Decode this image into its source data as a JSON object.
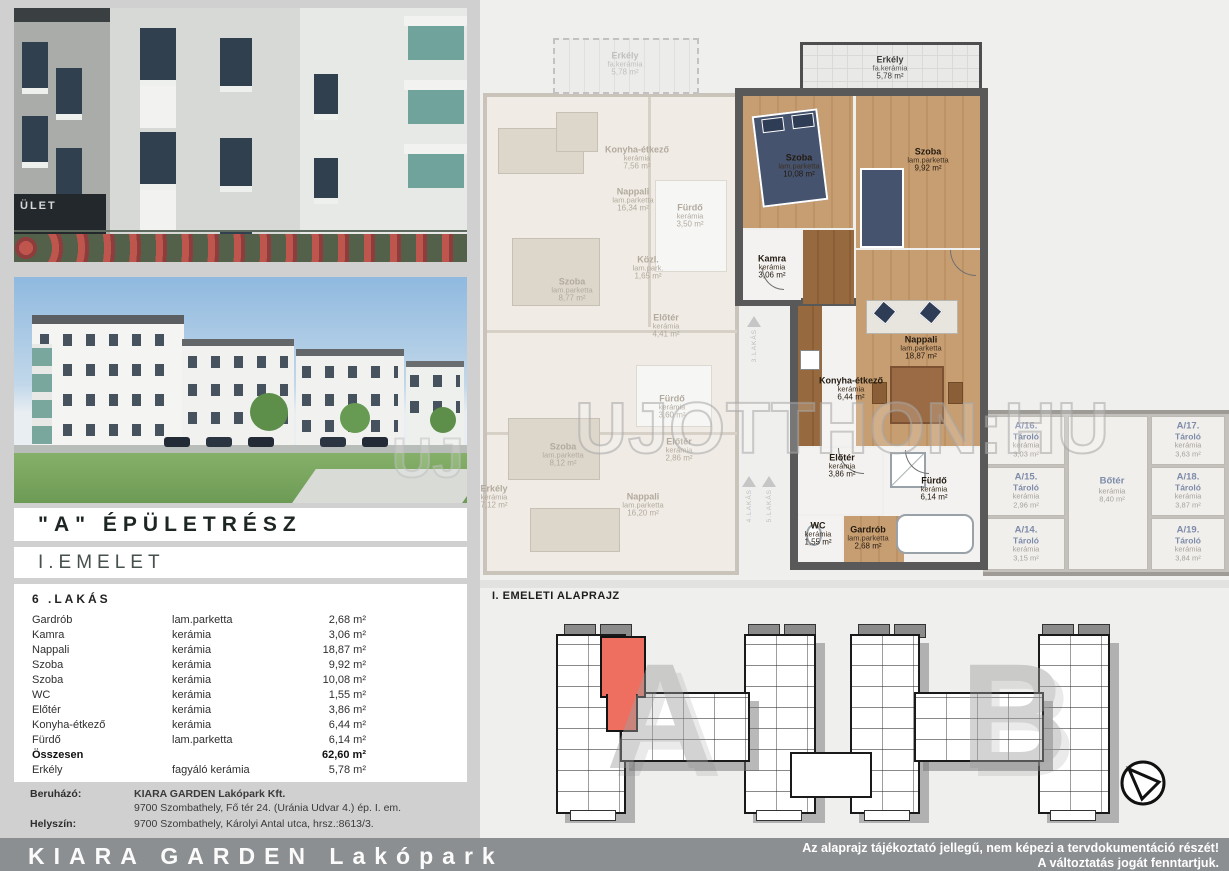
{
  "left": {
    "photo1": {
      "sign": "ÜLET"
    },
    "photo2": {
      "watermark": "UJ"
    },
    "building_title": "\"A\" ÉPÜLETRÉSZ",
    "floor_title": "I.EMELET",
    "table": {
      "title": "6 .LAKÁS",
      "rows": [
        {
          "name": "Gardrób",
          "material": "lam.parketta",
          "area": "2,68 m²"
        },
        {
          "name": "Kamra",
          "material": "kerámia",
          "area": "3,06 m²"
        },
        {
          "name": "Nappali",
          "material": "kerámia",
          "area": "18,87 m²"
        },
        {
          "name": "Szoba",
          "material": "kerámia",
          "area": "9,92 m²"
        },
        {
          "name": "Szoba",
          "material": "kerámia",
          "area": "10,08 m²"
        },
        {
          "name": "WC",
          "material": "kerámia",
          "area": "1,55 m²"
        },
        {
          "name": "Előtér",
          "material": "kerámia",
          "area": "3,86 m²"
        },
        {
          "name": "Konyha-étkező",
          "material": "kerámia",
          "area": "6,44 m²"
        },
        {
          "name": "Fürdő",
          "material": "lam.parketta",
          "area": "6,14 m²"
        }
      ],
      "total": {
        "name": "Összesen",
        "area": "62,60 m²"
      },
      "balcony": {
        "name": "Erkély",
        "material": "fagyáló kerámia",
        "area": "5,78 m²"
      }
    },
    "info": {
      "developer_label": "Beruházó:",
      "developer_name": "KIARA GARDEN Lakópark Kft.",
      "developer_address": "9700 Szombathely, Fő tér 24. (Uránia Udvar 4.) ép. I. em.",
      "site_label": "Helyszín:",
      "site_address": "9700 Szombathely, Károlyi Antal utca, hrsz.:8613/3."
    }
  },
  "footer": {
    "brand": "KIARA GARDEN Lakópark",
    "disclaimer1": "Az alaprajz tájékoztató jellegű, nem képezi a tervdokumentáció részét!",
    "disclaimer2": "A változtatás jogát fenntartjuk."
  },
  "plan": {
    "watermark": "UJOTTHON:HU",
    "balcony_main": {
      "name": "Erkély",
      "material": "fa.kerámia",
      "area": "5,78 m²"
    },
    "balcony_faded": {
      "name": "Erkély",
      "material": "fa.kerámia",
      "area": "5,78 m²"
    },
    "main_flat": [
      {
        "name": "Szoba",
        "material": "lam.parketta",
        "area": "10,08 m²"
      },
      {
        "name": "Szoba",
        "material": "lam.parketta",
        "area": "9,92 m²"
      },
      {
        "name": "Kamra",
        "material": "kerámia",
        "area": "3,06 m²"
      },
      {
        "name": "Nappali",
        "material": "lam.parketta",
        "area": "18,87 m²"
      },
      {
        "name": "Konyha-étkező",
        "material": "kerámia",
        "area": "6,44 m²"
      },
      {
        "name": "Előtér",
        "material": "kerámia",
        "area": "3,86 m²"
      },
      {
        "name": "Fürdő",
        "material": "kerámia",
        "area": "6,14 m²"
      },
      {
        "name": "WC",
        "material": "kerámia",
        "area": "1,55 m²"
      },
      {
        "name": "Gardrób",
        "material": "lam.parketta",
        "area": "2,68 m²"
      }
    ],
    "faded_flat": [
      {
        "name": "Konyha-étkező",
        "material": "kerámia",
        "area": "7,56 m²"
      },
      {
        "name": "Nappali",
        "material": "lam.parketta",
        "area": "16,34 m²"
      },
      {
        "name": "Fürdő",
        "material": "kerámia",
        "area": "3,50 m²"
      },
      {
        "name": "Közl.",
        "material": "lam.park.",
        "area": "1,65 m²"
      },
      {
        "name": "Szoba",
        "material": "lam.parketta",
        "area": "8,77 m²"
      },
      {
        "name": "Előtér",
        "material": "kerámia",
        "area": "4,41 m²"
      },
      {
        "name": "Szoba",
        "material": "lam.parketta",
        "area": "8,12 m²"
      },
      {
        "name": "Fürdő",
        "material": "kerámia",
        "area": "3,60 m²"
      },
      {
        "name": "Előtér",
        "material": "kerámia",
        "area": "2,86 m²"
      },
      {
        "name": "Nappali",
        "material": "lam.parketta",
        "area": "16,20 m²"
      },
      {
        "name": "Erkély",
        "material": "kerámia",
        "area": "7,12 m²"
      }
    ],
    "storage": [
      {
        "name": "A/16.",
        "type": "Tároló",
        "material": "kerámia",
        "area": "3,03 m²"
      },
      {
        "name": "A/15.",
        "type": "Tároló",
        "material": "kerámia",
        "area": "2,96 m²"
      },
      {
        "name": "A/14.",
        "type": "Tároló",
        "material": "kerámia",
        "area": "3,15 m²"
      },
      {
        "name": "Bőtér",
        "type": "",
        "material": "kerámia",
        "area": "8,40 m²"
      },
      {
        "name": "A/17.",
        "type": "Tároló",
        "material": "kerámia",
        "area": "3,63 m²"
      },
      {
        "name": "A/18.",
        "type": "Tároló",
        "material": "kerámia",
        "area": "3,87 m²"
      },
      {
        "name": "A/19.",
        "type": "Tároló",
        "material": "kerámia",
        "area": "3,84 m²"
      }
    ],
    "corridor": [
      "3.LAKÁS",
      "4.LAKÁS",
      "5.LAKÁS"
    ]
  },
  "overview": {
    "title": "I. EMELETI ALAPRAJZ",
    "letters": [
      "A",
      "B"
    ]
  }
}
